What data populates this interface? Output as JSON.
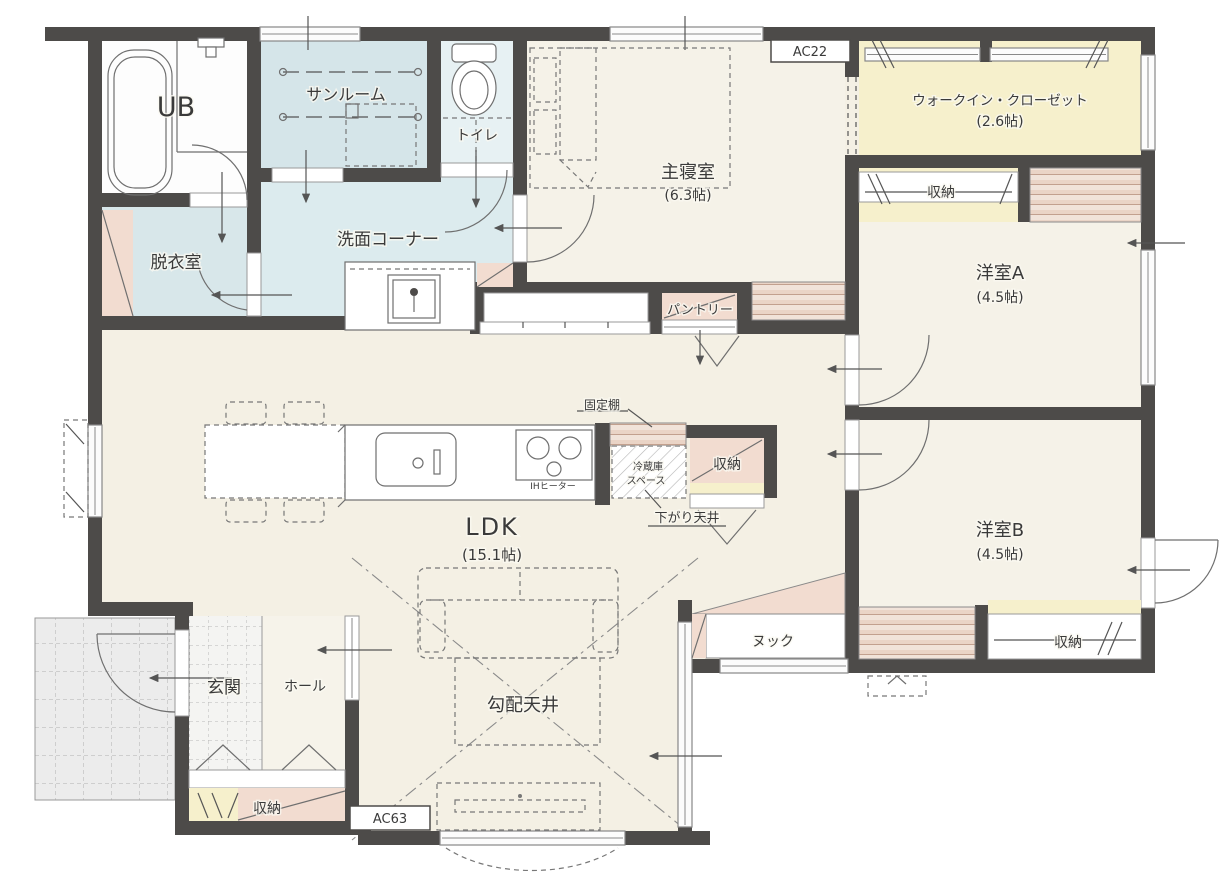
{
  "palette": {
    "wall": "#4d4b49",
    "floor_main": "#f4f0e4",
    "floor_bedroom": "#f5f2e8",
    "floor_wet_sunroom": "#d5e5e9",
    "floor_wet_washroom": "#dcebee",
    "floor_wet_dressing": "#d8e7ea",
    "floor_toilet": "#e7f1f3",
    "floor_yellow": "#f6f0cc",
    "floor_pink": "#f2dcd0",
    "porch_gray": "#ececec",
    "entrance_tile": "#f4f4f2",
    "hall_floor": "#f6f3ea"
  },
  "rooms": {
    "ub": {
      "label": "UB"
    },
    "sunroom": {
      "label": "サンルーム"
    },
    "toilet": {
      "label": "トイレ"
    },
    "dressing": {
      "label": "脱衣室"
    },
    "washroom": {
      "label": "洗面コーナー"
    },
    "master": {
      "label": "主寝室",
      "size": "(6.3帖)"
    },
    "wic": {
      "label": "ウォークイン・クローゼット",
      "size": "(2.6帖)"
    },
    "roomA": {
      "label": "洋室A",
      "size": "(4.5帖)"
    },
    "roomB": {
      "label": "洋室B",
      "size": "(4.5帖)"
    },
    "ldk": {
      "label": "LDK",
      "size": "(15.1帖)"
    },
    "entrance": {
      "label": "玄関"
    },
    "hall": {
      "label": "ホール"
    },
    "nook": {
      "label": "ヌック"
    },
    "pantry": {
      "label": "パントリー"
    }
  },
  "storage_labels": {
    "wic_row": "収納",
    "kitchen": "収納",
    "entrance": "収納",
    "roomB": "収納"
  },
  "features": {
    "sloped_ceiling": "勾配天井",
    "lowered_ceiling": "下がり天井",
    "fixed_shelf": "固定棚",
    "fridge_line1": "冷蔵庫",
    "fridge_line2": "スペース",
    "ih_heater": "IHヒーター"
  },
  "annotations": {
    "ac_top": "AC22",
    "ac_bottom": "AC63"
  }
}
